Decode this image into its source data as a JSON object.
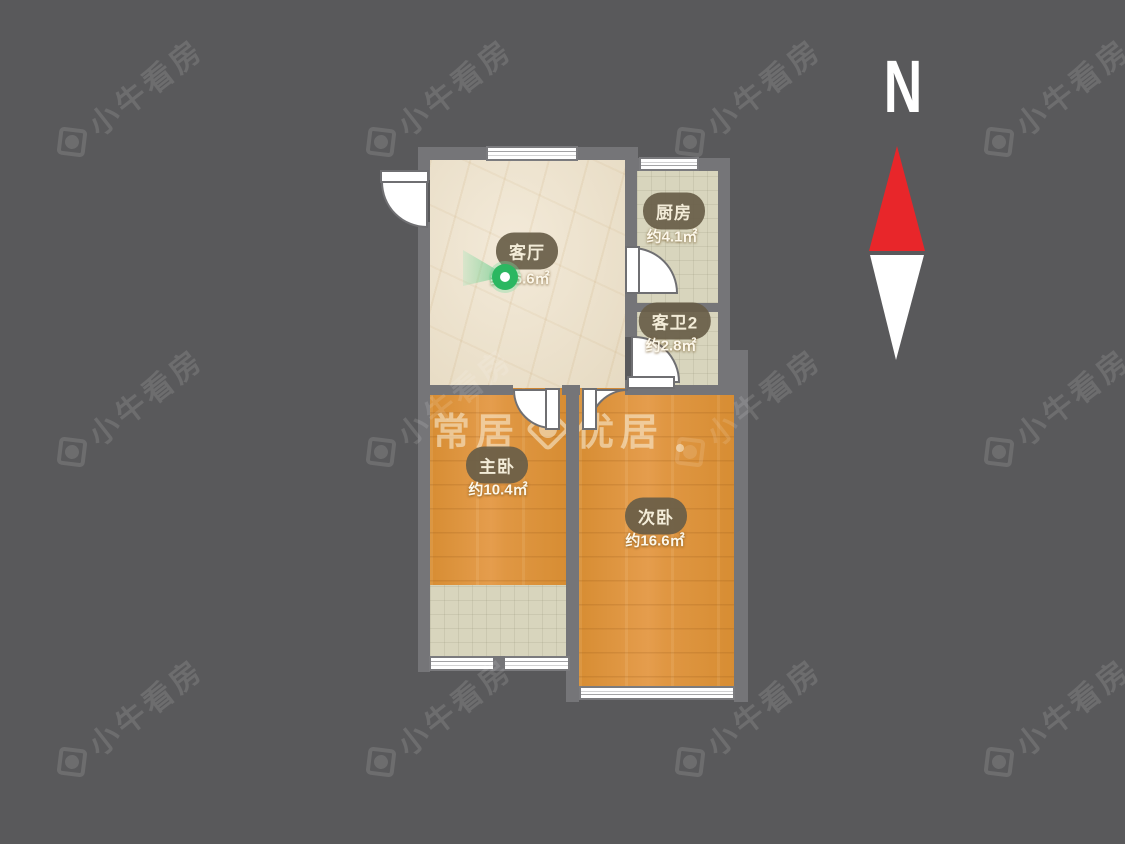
{
  "compass": {
    "label": "N"
  },
  "watermark": {
    "tile_text": "小牛看房",
    "center_left": "常居",
    "center_right": "优居"
  },
  "rooms": [
    {
      "id": "living-room",
      "name": "客厅",
      "area": "约16.6㎡"
    },
    {
      "id": "kitchen",
      "name": "厨房",
      "area": "约4.1㎡"
    },
    {
      "id": "guest-bath-2",
      "name": "客卫2",
      "area": "约2.8㎡"
    },
    {
      "id": "master-bedroom",
      "name": "主卧",
      "area": "约10.4㎡"
    },
    {
      "id": "second-bedroom",
      "name": "次卧",
      "area": "约16.6㎡"
    }
  ],
  "colors": {
    "background": "#59595b",
    "wall": "#757578",
    "wood_floor": "#dd9540",
    "tile_floor": "#d8d5bd",
    "marble_floor": "#ede3d0",
    "compass_needle_red": "#e8262a",
    "panorama_green": "#2bb761"
  }
}
